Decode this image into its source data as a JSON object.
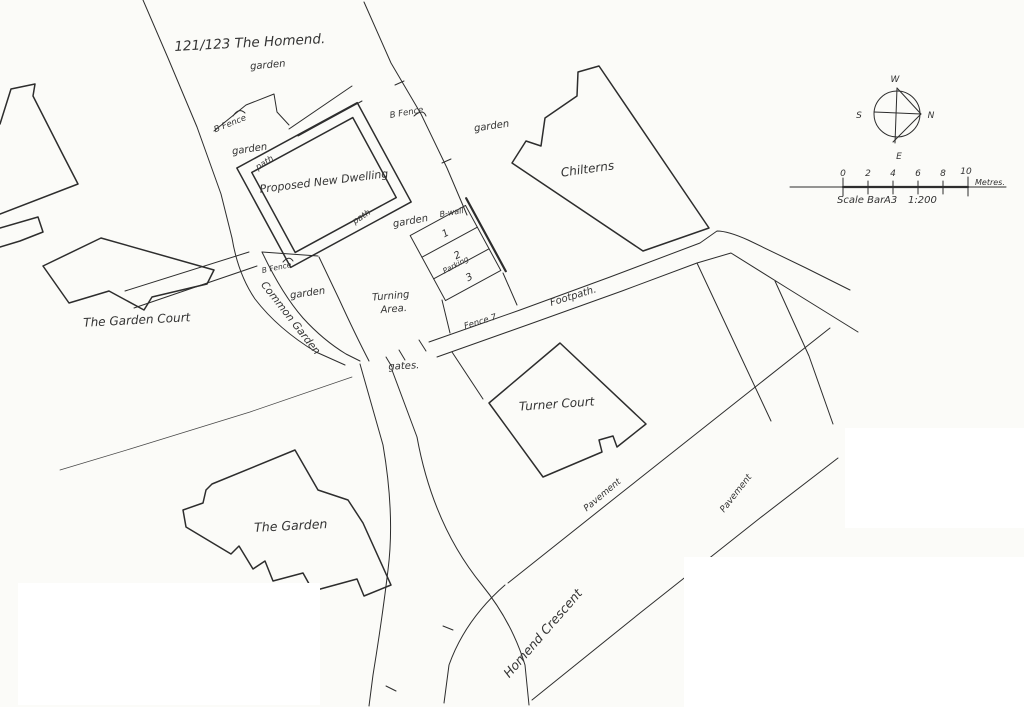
{
  "page": {
    "background": "#fbfbf8",
    "ink_color": "#2d2d2d",
    "patch_color": "#ffffff"
  },
  "labels": {
    "site_title": "121/123 The Homend.",
    "garden": "garden",
    "b_fence": "B Fence",
    "path": "path",
    "proposed_dwelling": "Proposed New Dwelling",
    "chilterns": "Chilterns",
    "b_wall": "B-wall",
    "turning_area_line1": "Turning",
    "turning_area_line2": "Area.",
    "footpath": "Footpath.",
    "fence_7": "Fence 7",
    "gates": "gates.",
    "common_garden": "Common Garden",
    "the_garden_court": "The Garden Court",
    "turner_court": "Turner Court",
    "the_garden": "The Garden",
    "pavement": "Pavement",
    "homend_crescent": "Homend Crescent"
  },
  "parking": {
    "label": "Parking",
    "bays": [
      "1",
      "2",
      "3"
    ]
  },
  "compass": {
    "north": "N",
    "south": "S",
    "east": "E",
    "west": "W"
  },
  "scale_bar": {
    "ticks": [
      "0",
      "2",
      "4",
      "6",
      "8",
      "10"
    ],
    "unit": "Metres.",
    "label": "Scale Bar",
    "sheet": "A3",
    "ratio": "1:200"
  }
}
